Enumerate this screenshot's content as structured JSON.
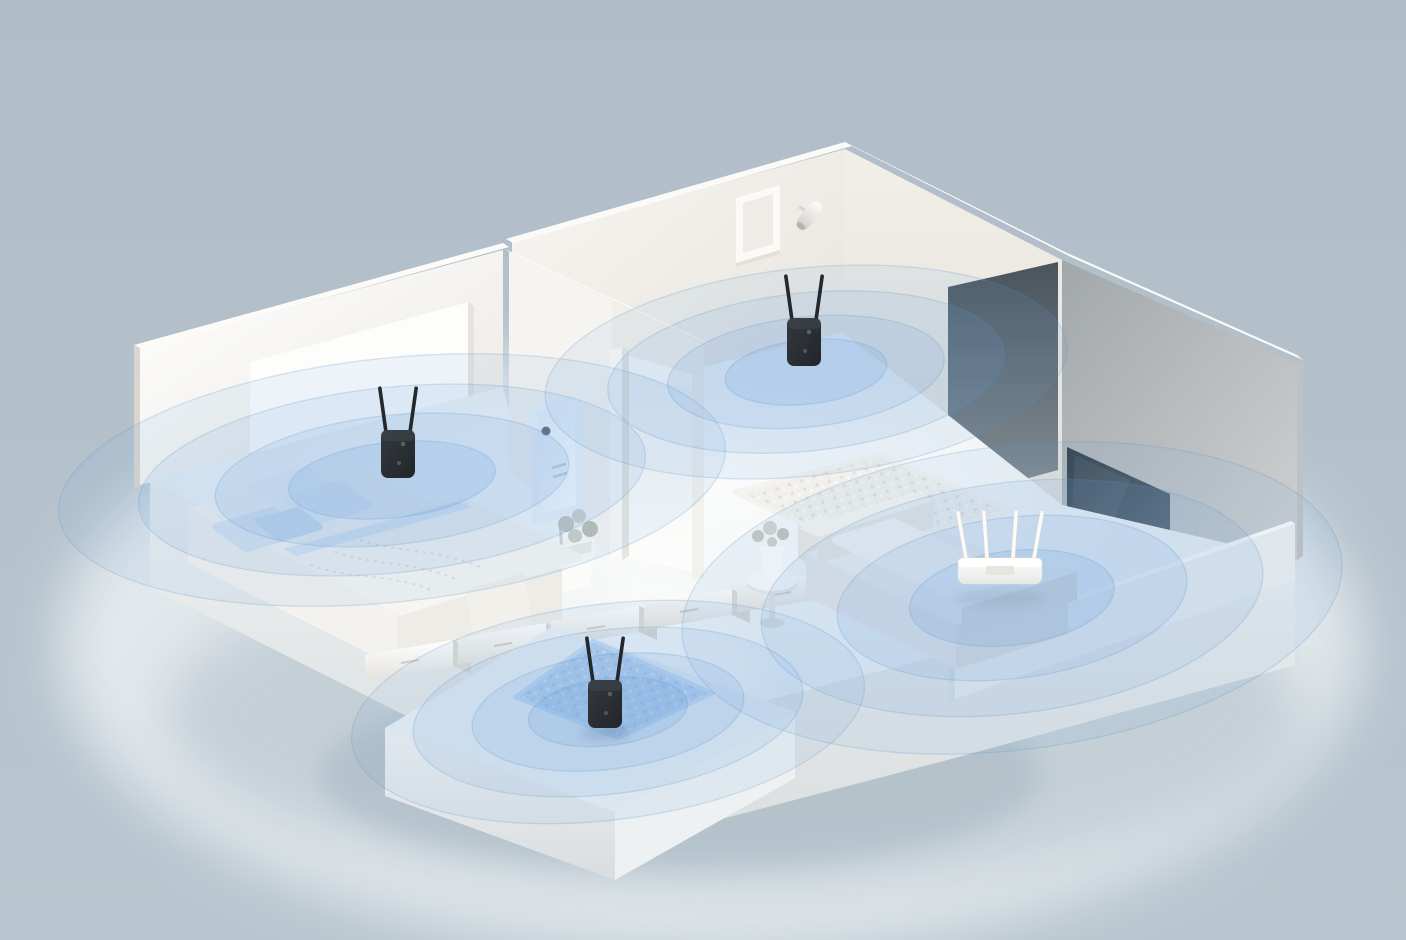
{
  "page": {
    "title": "Whole-home Wi-Fi coverage — isometric apartment illustration",
    "caption": "3D cutaway of an apartment: a four-antenna Wi-Fi router in the living room and three two-antenna Wi-Fi range extenders (bedroom, hallway, balcony) each radiating concentric blue signal ripples."
  },
  "scene": {
    "background_color": "#b2bfc9",
    "ground_glow_color": "#e7edf0",
    "ground_shadow_color": "#8fa2b0",
    "signal_color": "#6fa3dd",
    "signal_stroke_color": "#5890cb",
    "rooms": [
      {
        "id": "bedroom",
        "features": [
          "bed",
          "pillows",
          "headboard-panel",
          "wall-heater",
          "plant"
        ]
      },
      {
        "id": "hallway",
        "features": [
          "shag-rug",
          "picture-frame",
          "wall-lamp",
          "doorway",
          "side-table",
          "vase-of-flowers"
        ]
      },
      {
        "id": "living-room",
        "features": [
          "l-shaped-sofa",
          "tv-screen",
          "tv-console",
          "parapet-wall"
        ]
      },
      {
        "id": "balcony",
        "features": [
          "blue-shag-rug",
          "cabinet-row"
        ]
      }
    ],
    "cabinets": {
      "count": 6
    },
    "devices": [
      {
        "id": "router-living-room",
        "type": "wifi-router",
        "label": "Wi-Fi router",
        "antennas": 4,
        "body_color": "#ffffff",
        "location": "living-room",
        "x": 1000,
        "y": 558,
        "standing": false
      },
      {
        "id": "extender-bedroom",
        "type": "wifi-extender",
        "label": "Wi-Fi range extender",
        "antennas": 2,
        "body_color": "#2b2f33",
        "location": "bedroom",
        "x": 398,
        "y": 430,
        "standing": false
      },
      {
        "id": "extender-hallway",
        "type": "wifi-extender",
        "label": "Wi-Fi range extender",
        "antennas": 2,
        "body_color": "#2b2f33",
        "location": "hallway",
        "x": 804,
        "y": 318,
        "standing": false
      },
      {
        "id": "extender-balcony",
        "type": "wifi-extender",
        "label": "Wi-Fi range extender",
        "antennas": 2,
        "body_color": "#2b2f33",
        "location": "balcony",
        "x": 605,
        "y": 680,
        "standing": true
      }
    ],
    "ripples": [
      {
        "device": "extender-bedroom",
        "cx": 392,
        "cy": 480,
        "rx": 335,
        "ry": 122,
        "rot": -6
      },
      {
        "device": "extender-hallway",
        "cx": 806,
        "cy": 372,
        "rx": 262,
        "ry": 104,
        "rot": -6
      },
      {
        "device": "router-living-room",
        "cx": 1012,
        "cy": 598,
        "rx": 332,
        "ry": 152,
        "rot": -7
      },
      {
        "device": "extender-balcony",
        "cx": 608,
        "cy": 712,
        "rx": 258,
        "ry": 108,
        "rot": -7
      }
    ]
  }
}
